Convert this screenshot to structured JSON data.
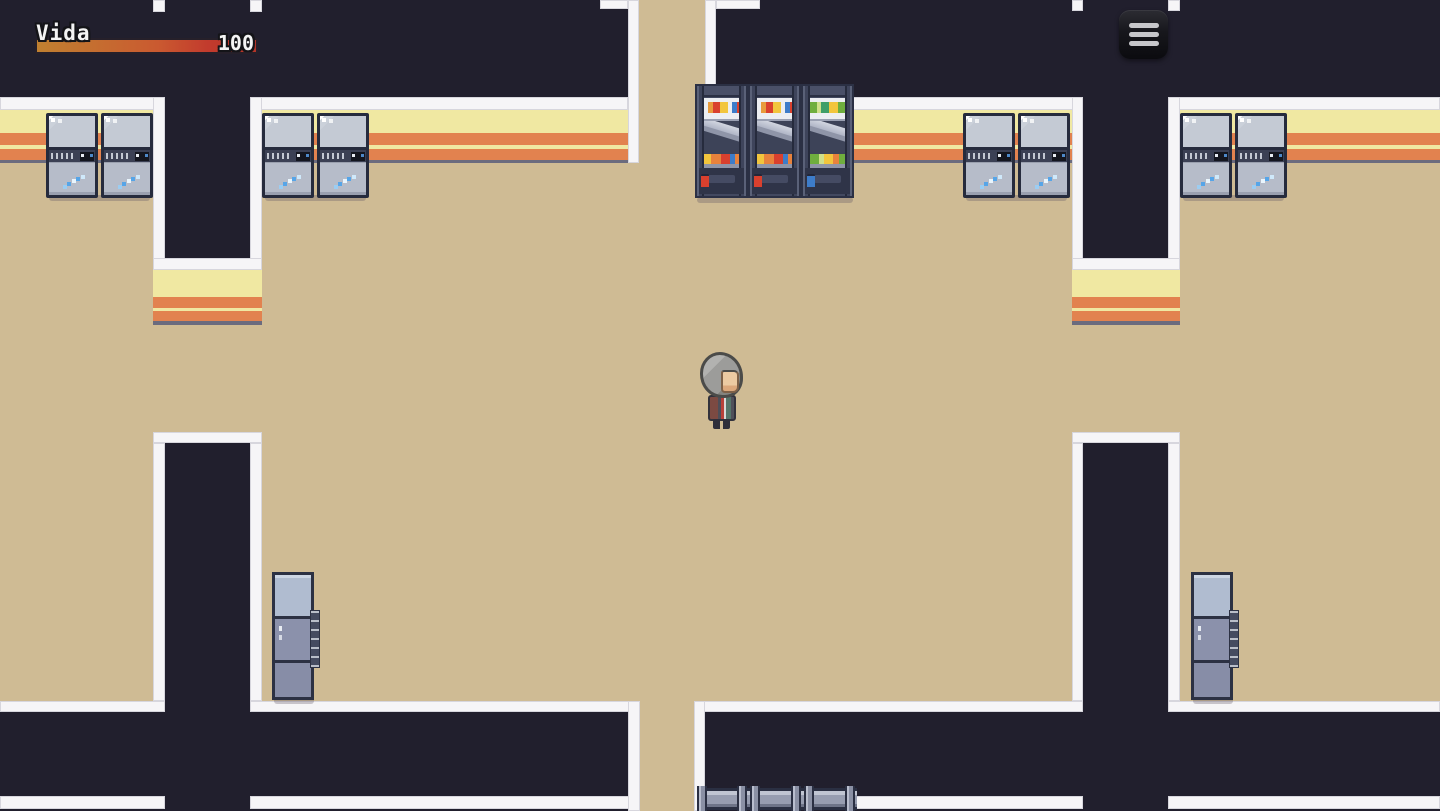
{
  "hud": {
    "health_label": "Vida",
    "health_value": "100",
    "health_percent": 100,
    "bar_color_left": "#c08030",
    "bar_color_right": "#c23b2d"
  },
  "menu_button": {
    "icon": "hamburger-menu-icon",
    "action": "open-game-menu"
  },
  "scene": {
    "setting": "pixel-art interior hallway crossroads (RPG style)",
    "player": {
      "sprite": "gray-haired character",
      "location": "center of room"
    },
    "objects": [
      {
        "name": "vending-machine",
        "count": 3,
        "location": "top center wall"
      },
      {
        "name": "double-locker",
        "count": 4,
        "location": "upper walls left and right"
      },
      {
        "name": "tall-locker",
        "count": 2,
        "location": "lower side walls"
      },
      {
        "name": "wall-pipe",
        "count": 1,
        "location": "bottom center wall"
      }
    ],
    "palette": {
      "floor": "#cfbb94",
      "wall_dark": "#211f2d",
      "trim_white": "#f6f5f7",
      "wall_face_yellow": "#f0e8a2",
      "wall_face_orange": "#e2824f",
      "wall_face_base_gray": "#6b6b7e"
    }
  }
}
